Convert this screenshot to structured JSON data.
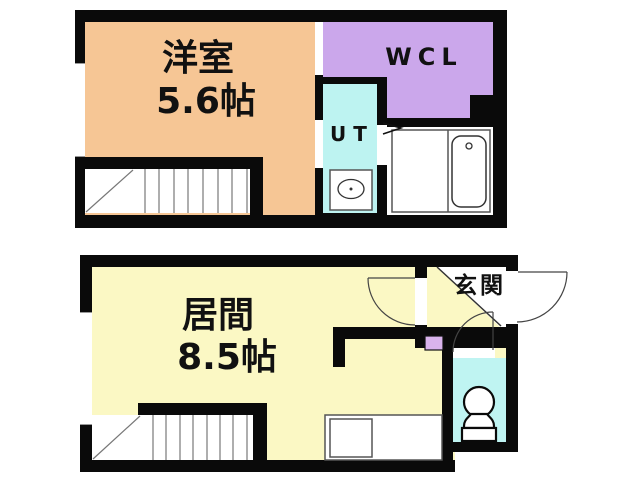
{
  "plan": {
    "upper_floor": {
      "western_room": {
        "name": "洋室",
        "size": "5.6帖"
      },
      "walk_in_closet": {
        "label": "WCL"
      },
      "utility": {
        "label": "UT"
      }
    },
    "lower_floor": {
      "living_room": {
        "name": "居間",
        "size": "8.5帖"
      },
      "entrance": {
        "label": "玄関"
      }
    }
  },
  "colors": {
    "wall": "#0A0A0A",
    "western_room": "#F6C695",
    "wcl": "#CBA7EB",
    "ut": "#BDF3F1",
    "living": "#FBF8C4",
    "toilet": "#BFF4F2",
    "storage_box": "#D9B3EC",
    "background": "#FFFFFF"
  }
}
